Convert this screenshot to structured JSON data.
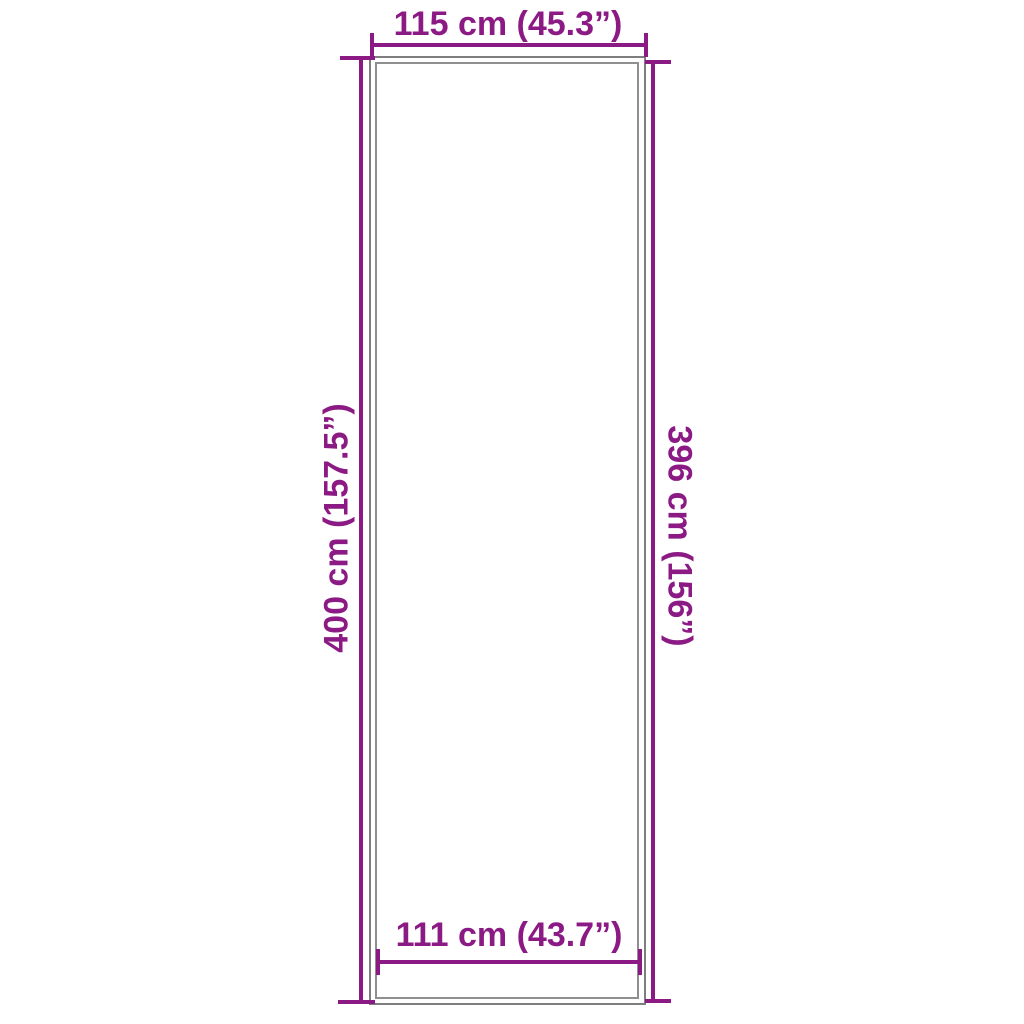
{
  "page": {
    "background": "#ffffff",
    "accent_color": "#8c1a84",
    "outline_color": "#7e7e7e"
  },
  "diagram": {
    "kind": "product-dimension-diagram",
    "labels": {
      "top": "115 cm (45.3”)",
      "left": "400 cm (157.5”)",
      "right": "396 cm (156”)",
      "bottom": "111 cm (43.7”)"
    }
  }
}
